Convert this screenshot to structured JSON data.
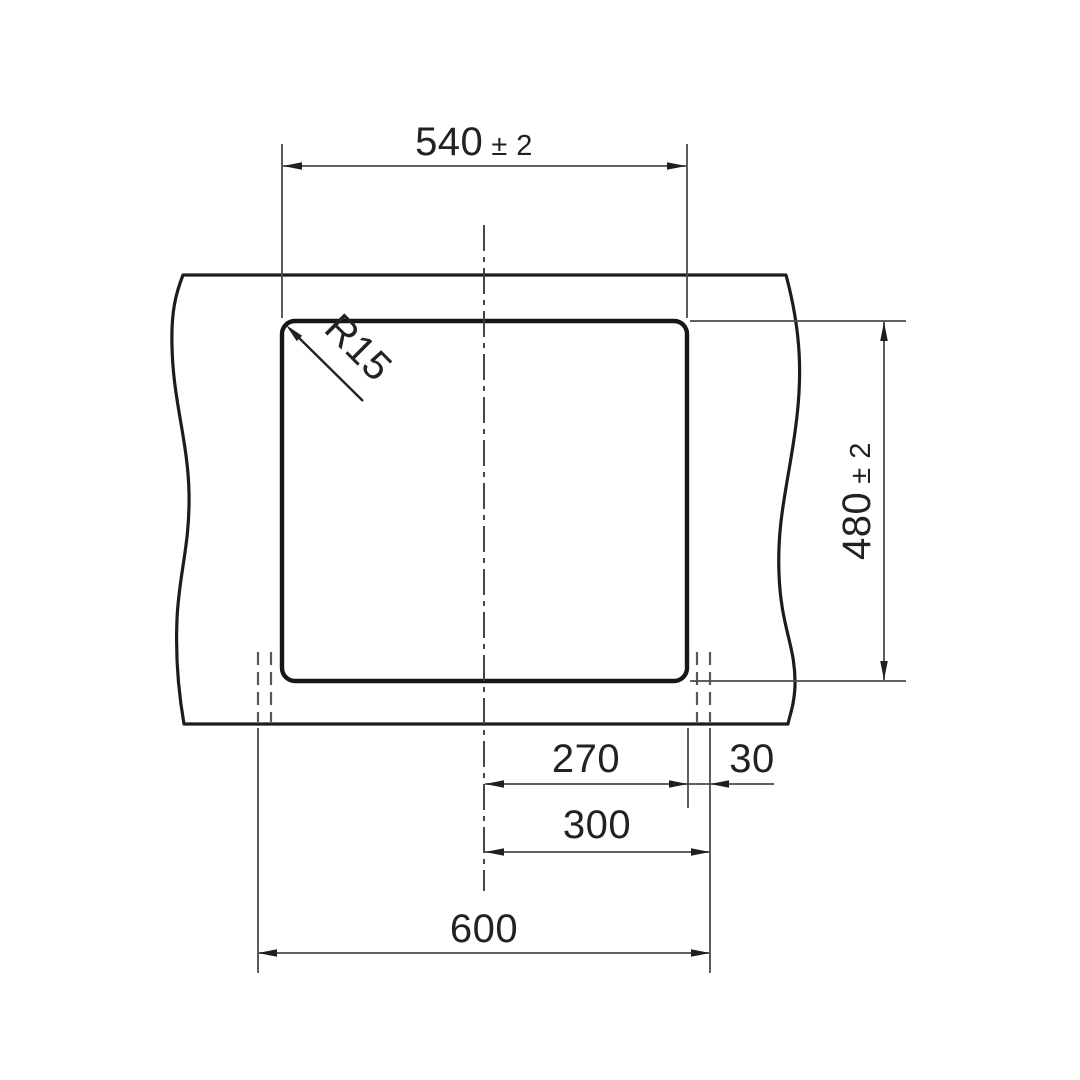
{
  "colors": {
    "background": "#ffffff",
    "object_line": "#1c1c1c",
    "dimension_line": "#4a4a4a",
    "text": "#222222"
  },
  "drawing": {
    "kind": "technical dimension drawing",
    "dimensions": {
      "cutout_width": {
        "value": "540",
        "tolerance": "± 2"
      },
      "cutout_height": {
        "value": "480",
        "tolerance": "± 2"
      },
      "corner_radius": {
        "value": "R15"
      },
      "center_to_cutout_edge": {
        "value": "270"
      },
      "cutout_edge_to_sink_edge": {
        "value": "30"
      },
      "center_to_sink_edge": {
        "value": "300"
      },
      "sink_overall_width": {
        "value": "600"
      }
    }
  }
}
